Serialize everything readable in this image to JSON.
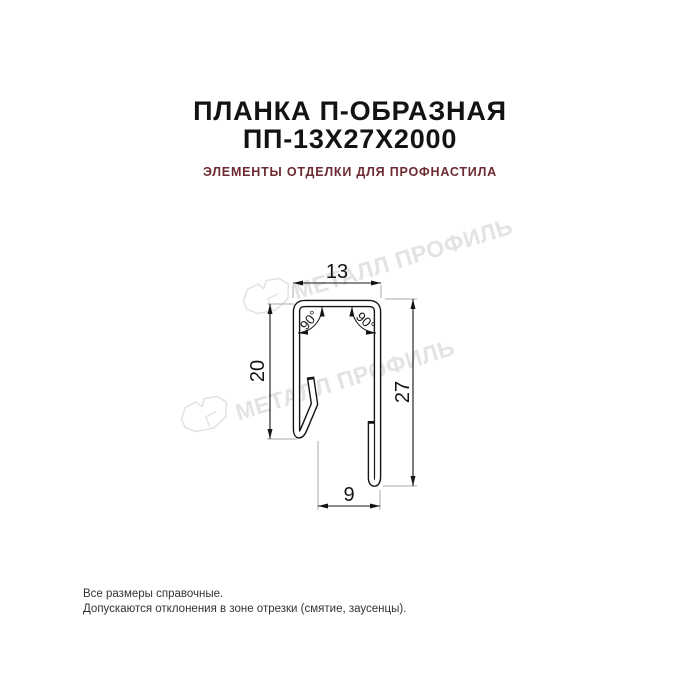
{
  "header": {
    "title_line1": "ПЛАНКА П-ОБРАЗНАЯ",
    "title_line2": "ПП-13Х27Х2000",
    "subtitle": "ЭЛЕМЕНТЫ ОТДЕЛКИ ДЛЯ ПРОФНАСТИЛА"
  },
  "watermark": {
    "text": "МЕТАЛЛ ПРОФИЛЬ",
    "color": "#e3e3e3"
  },
  "drawing": {
    "dimensions": {
      "top_width": "13",
      "left_height": "20",
      "right_height": "27",
      "bottom_width": "9"
    },
    "angles": {
      "left": "90°",
      "right": "90°"
    },
    "line_color": "#141414",
    "extension_line_color": "#ababab"
  },
  "footer": {
    "line1": "Все размеры справочные.",
    "line2": "Допускаются отклонения в зоне отрезки (смятие, заусенцы)."
  },
  "colors": {
    "title": "#131313",
    "subtitle": "#6d2a31",
    "background": "#ffffff"
  }
}
